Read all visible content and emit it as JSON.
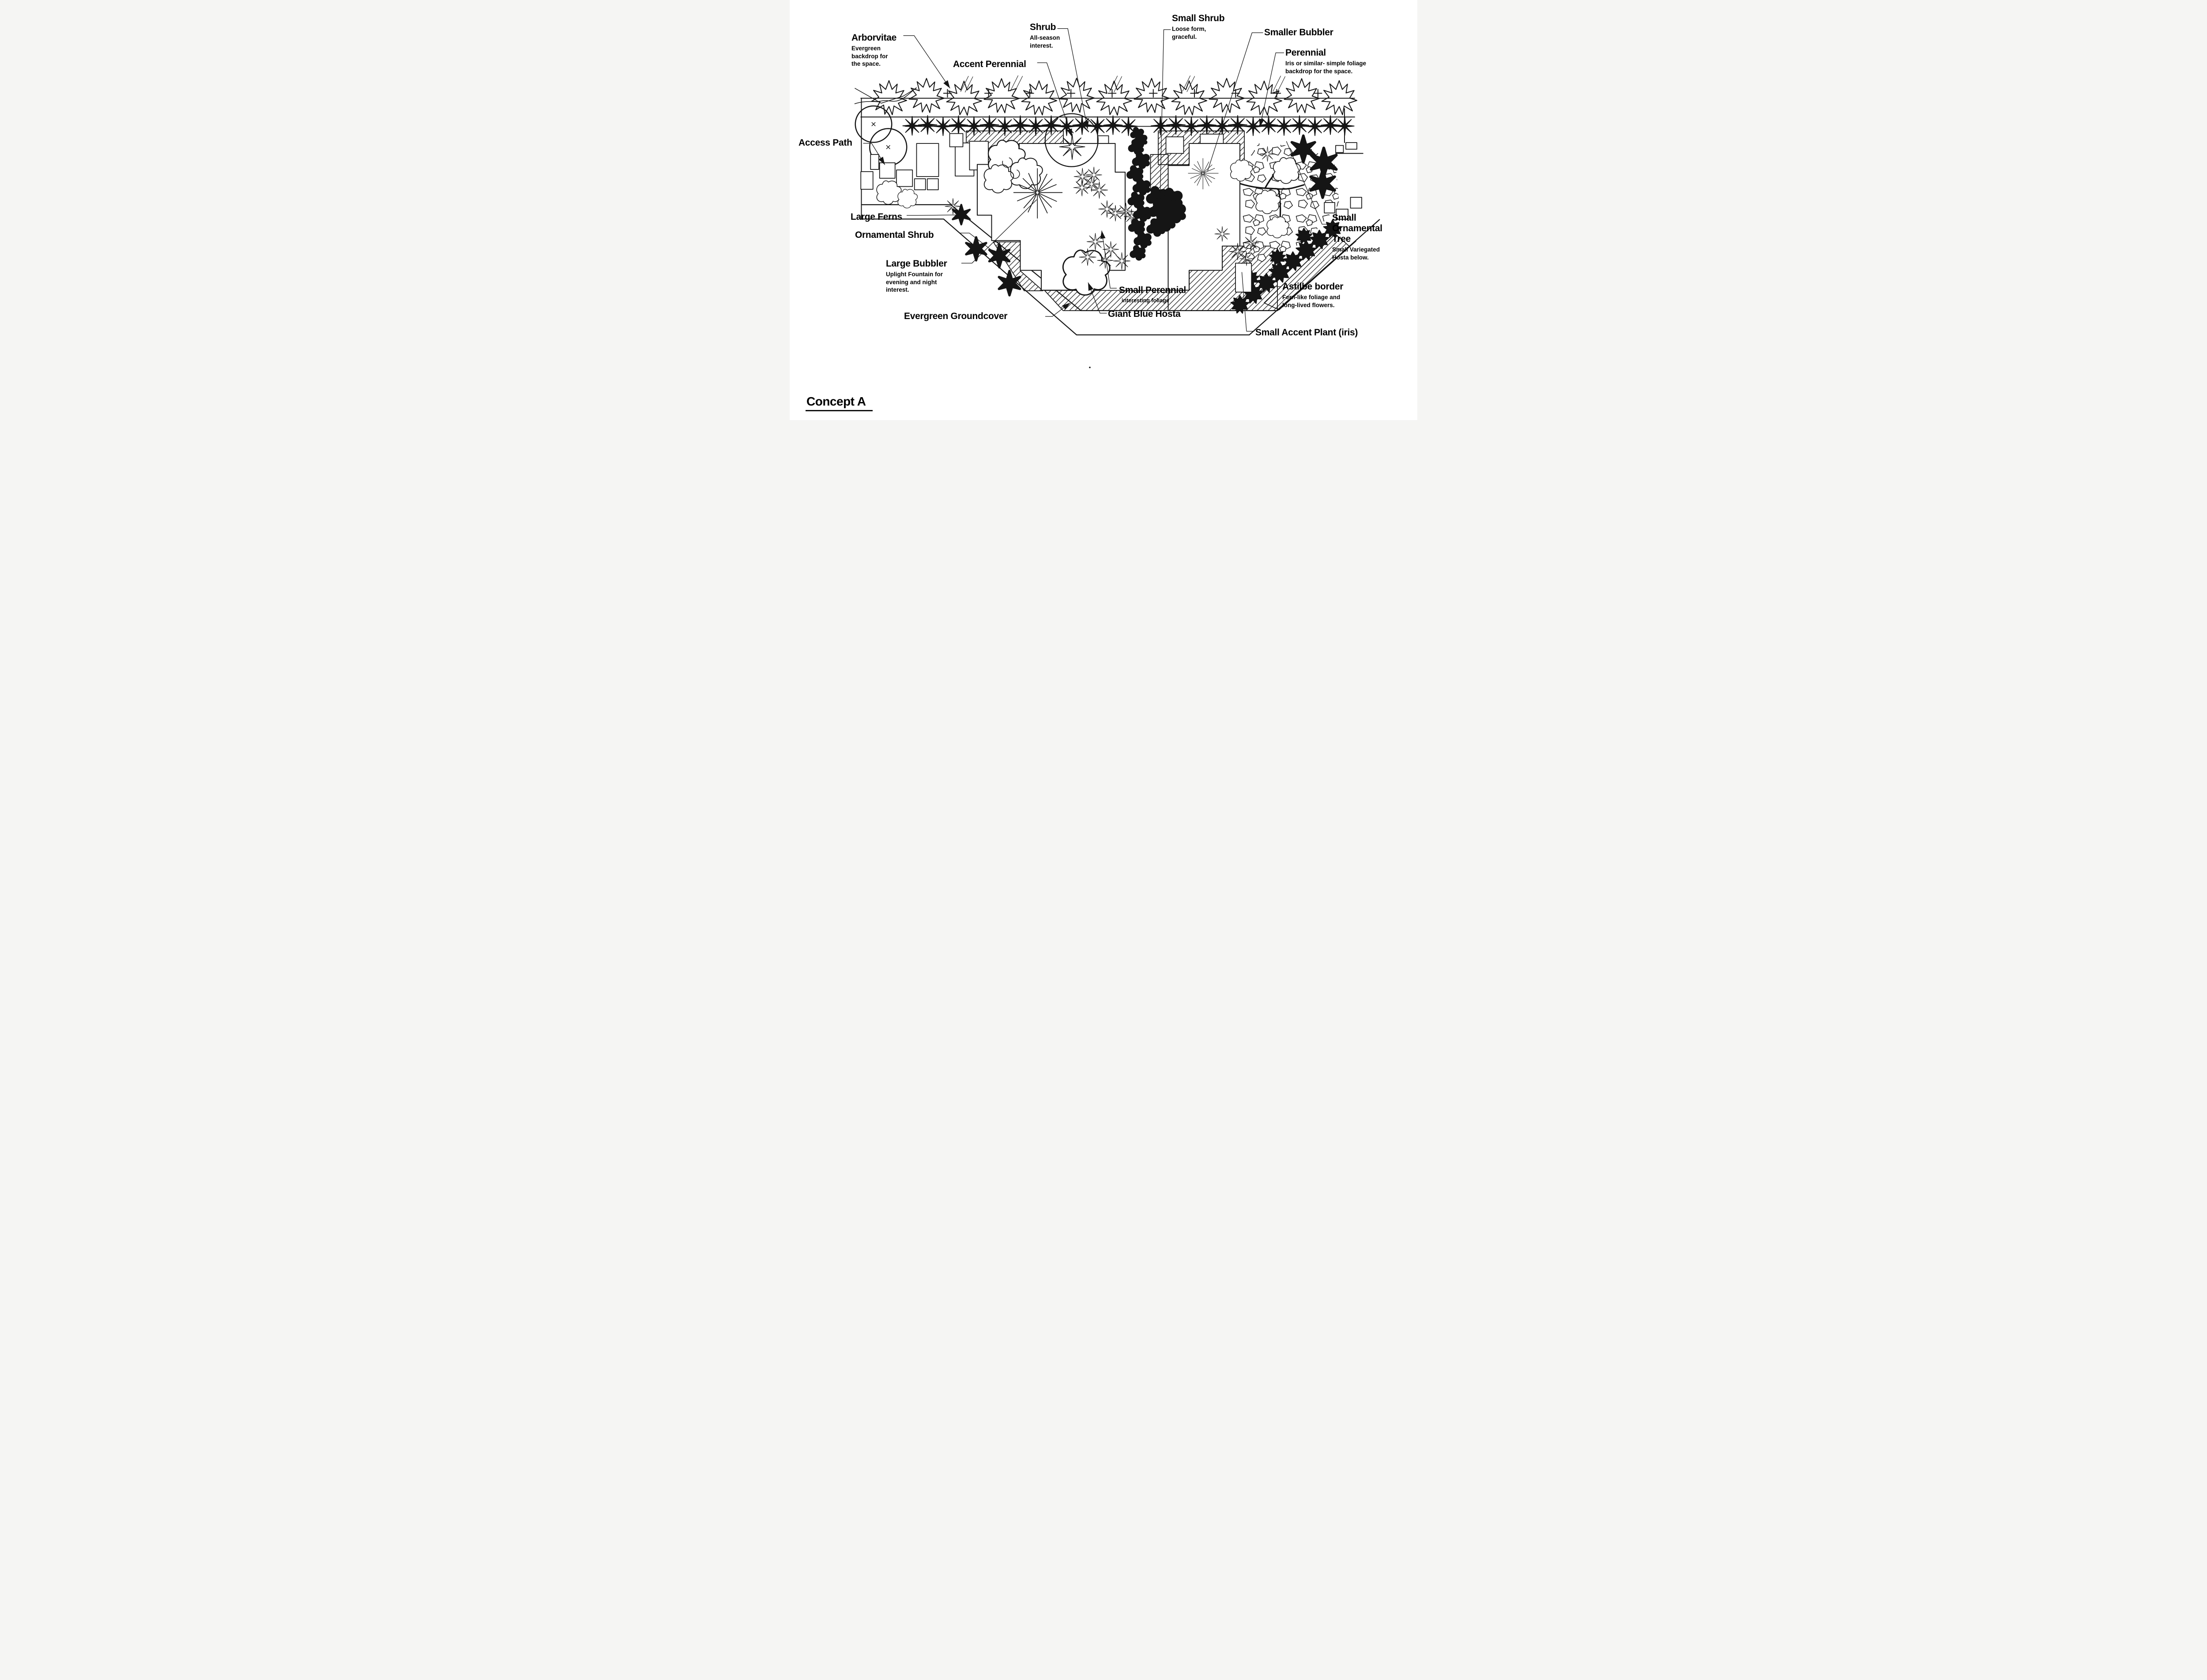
{
  "title": {
    "label": "Concept A"
  },
  "callouts": {
    "arborvitae": {
      "label": "Arborvitae",
      "desc": "Evergreen\nbackdrop for\nthe space."
    },
    "accent_perennial": {
      "label": "Accent Perennial"
    },
    "shrub": {
      "label": "Shrub",
      "desc": "All-season\ninterest."
    },
    "small_shrub": {
      "label": "Small Shrub",
      "desc": "Loose form,\ngraceful."
    },
    "smaller_bubbler": {
      "label": "Smaller Bubbler"
    },
    "perennial": {
      "label": "Perennial",
      "desc": "Iris or similar- simple foliage\nbackdrop for the space."
    },
    "access_path": {
      "label": "Access Path"
    },
    "large_ferns": {
      "label": "Large Ferns"
    },
    "ornamental_shrub": {
      "label": "Ornamental Shrub"
    },
    "large_bubbler": {
      "label": "Large Bubbler",
      "desc": "Uplight Fountain for\nevening and night\ninterest."
    },
    "evergreen_groundcover": {
      "label": "Evergreen Groundcover"
    },
    "small_perennial": {
      "label": "Small Perennial",
      "desc": "interesting foliage"
    },
    "giant_blue_hosta": {
      "label": "Giant Blue Hosta"
    },
    "small_ornamental_tree": {
      "label": "Small\nOrnamental\nTree",
      "desc": "Small Variegated\nHosta below."
    },
    "astilbe_border": {
      "label": "Astilbe border",
      "desc": "Fern-like foliage and\nlong-lived flowers."
    },
    "small_accent_plant": {
      "label": "Small Accent Plant (iris)"
    }
  },
  "colors": {
    "ink": "#151515",
    "paper": "#ffffff"
  }
}
